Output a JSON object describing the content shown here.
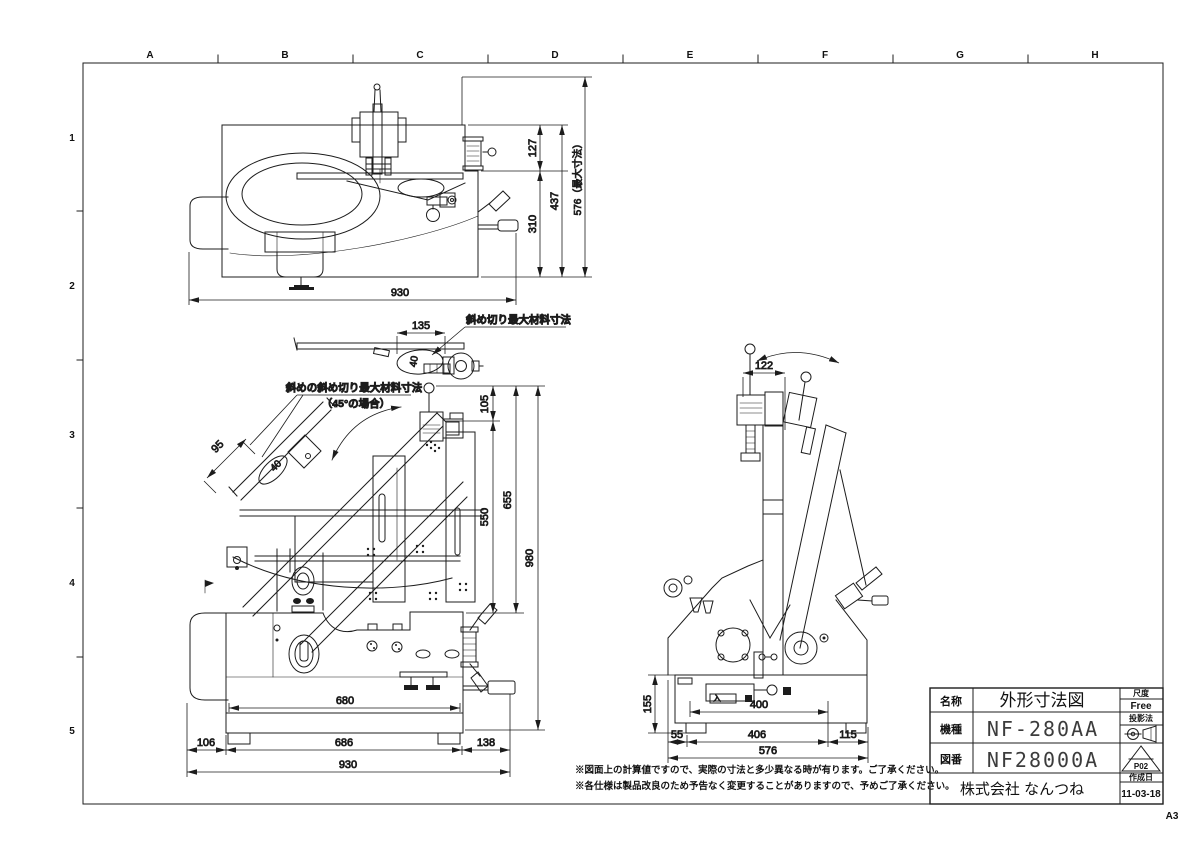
{
  "sheet": {
    "cols": [
      "A",
      "B",
      "C",
      "D",
      "E",
      "F",
      "G",
      "H"
    ],
    "rows": [
      "1",
      "2",
      "3",
      "4",
      "5"
    ],
    "size_label": "A3"
  },
  "dims": {
    "top": {
      "w930": "930",
      "h127": "127",
      "h310": "310",
      "h437": "437",
      "h576max": "576（最大寸法）"
    },
    "detail": {
      "w135": "135",
      "t40": "40",
      "label": "斜め切り最大材料寸法"
    },
    "front": {
      "label45": "斜めの斜め切り最大材料寸法",
      "case45": "（45°の場合）",
      "w95": "95",
      "t40": "40",
      "h105": "105",
      "h550": "550",
      "h655": "655",
      "h980": "980",
      "b680": "680",
      "b106": "106",
      "b686": "686",
      "b138": "138",
      "b930": "930"
    },
    "side": {
      "w122": "122",
      "h155": "155",
      "w400": "400",
      "b55": "55",
      "b406": "406",
      "b115": "115",
      "b576": "576",
      "drawer": "入"
    }
  },
  "notes": {
    "line1": "※図面上の計算値ですので、実際の寸法と多少異なる時が有ります。ご了承ください。",
    "line2": "※各仕様は製品改良のため予告なく変更することがありますので、予めご了承ください。"
  },
  "title_block": {
    "name_label": "名称",
    "name_value": "外形寸法図",
    "scale_label": "尺度",
    "scale_value": "Free",
    "model_label": "機種",
    "model_value": "NF-280AA",
    "projection_label": "投影法",
    "drawing_label": "図番",
    "drawing_value": "NF28000A",
    "revision": "P02",
    "company": "株式会社 なんつね",
    "date_label": "作成日",
    "date_value": "11-03-18"
  }
}
